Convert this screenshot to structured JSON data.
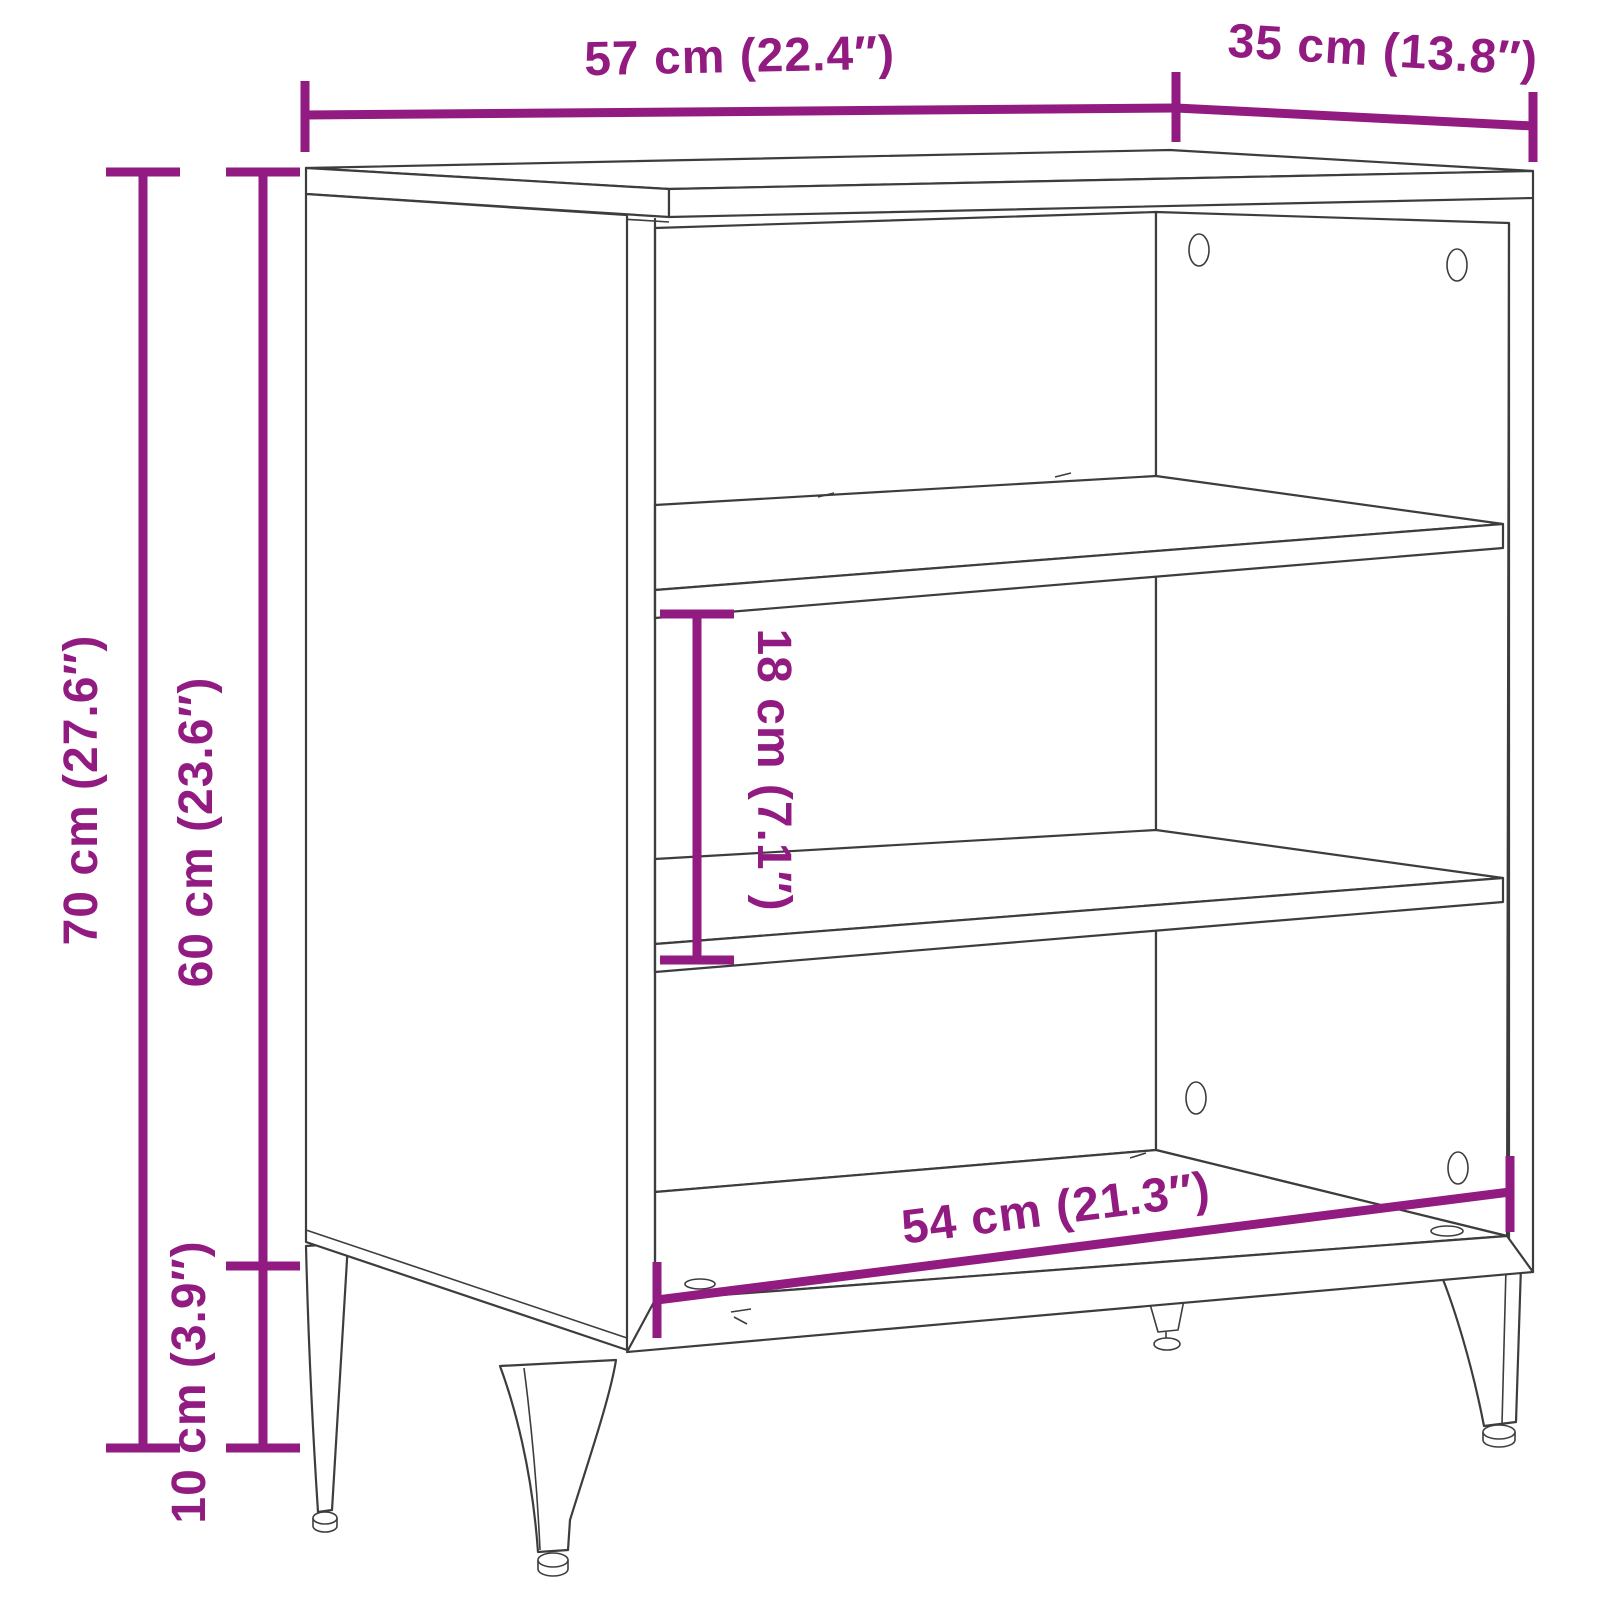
{
  "diagram": {
    "accent_color": "#911b80",
    "line_color": "#3d3d3d",
    "dimensions": {
      "width": {
        "label": "57 cm (22.4″)",
        "cm": 57,
        "inch": 22.4
      },
      "depth": {
        "label": "35 cm (13.8″)",
        "cm": 35,
        "inch": 13.8
      },
      "total_height": {
        "label": "70 cm (27.6″)",
        "cm": 70,
        "inch": 27.6
      },
      "body_height": {
        "label": "60 cm (23.6″)",
        "cm": 60,
        "inch": 23.6
      },
      "shelf_clearance": {
        "label": "18 cm (7.1″)",
        "cm": 18,
        "inch": 7.1
      },
      "leg_height": {
        "label": "10 cm (3.9″)",
        "cm": 10,
        "inch": 3.9
      },
      "inner_width": {
        "label": "54 cm (21.3″)",
        "cm": 54,
        "inch": 21.3
      }
    }
  }
}
